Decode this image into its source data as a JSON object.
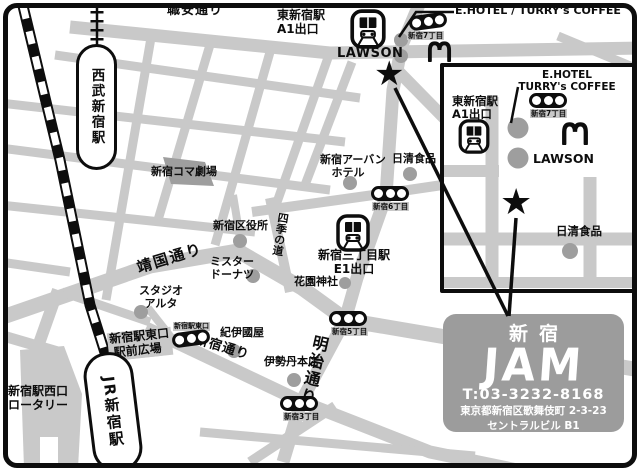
{
  "map": {
    "streets": {
      "shokuan": "職安通り",
      "yasukuni": "靖国通り",
      "shinjuku_dori": "新宿通り",
      "meiji": "明治通り",
      "shiki": "四季の道"
    },
    "stations": {
      "seibu": "西武新宿駅",
      "jr": "JR新宿駅",
      "higashi_line1": "東新宿駅",
      "higashi_line2": "A1出口",
      "sanchome_line1": "新宿三丁目駅",
      "sanchome_line2": "E1出口"
    },
    "landmarks": {
      "ehotel_top": "E.HOTEL / TURRY's COFFEE",
      "lawson": "LAWSON",
      "koma": "新宿コマ劇場",
      "urban_hotel_line1": "新宿アーバン",
      "urban_hotel_line2": "ホテル",
      "nissin": "日清食品",
      "kuyakusho": "新宿区役所",
      "mister_line1": "ミスター",
      "mister_line2": "ドーナツ",
      "hanazono": "花園神社",
      "alta_line1": "スタジオ",
      "alta_line2": "アルタ",
      "kinokuniya": "紀伊國屋",
      "isetan": "伊勢丹本店",
      "east_exit_line1": "新宿駅東口",
      "east_exit_line2": "駅前広場",
      "east_exit_small": "新宿駅東口",
      "west_exit_line1": "新宿駅西口",
      "west_exit_line2": "ロータリー"
    },
    "signals": {
      "s7": "新宿7丁目",
      "s6": "新宿6丁目",
      "s5": "新宿5丁目",
      "s3": "新宿3丁目",
      "east": "新宿駅東口"
    },
    "inset": {
      "ehotel_line1": "E.HOTEL",
      "ehotel_line2": "TURRY's COFFEE",
      "station_line1": "東新宿駅",
      "station_line2": "A1出口",
      "signal": "新宿7丁目",
      "lawson": "LAWSON",
      "nissin": "日清食品"
    },
    "venue": {
      "name_jp": "新宿",
      "name_logo": "JAM",
      "tel": "T:03-3232-8168",
      "address": "東京都新宿区歌舞伎町 2-3-23",
      "building": "セントラルビル B1"
    },
    "icons": {
      "star": "★"
    },
    "colors": {
      "road": "#c9c9c9",
      "dot": "#9e9e9e",
      "venue_bg": "#9c9c9c",
      "line": "#0d0d0d"
    }
  }
}
